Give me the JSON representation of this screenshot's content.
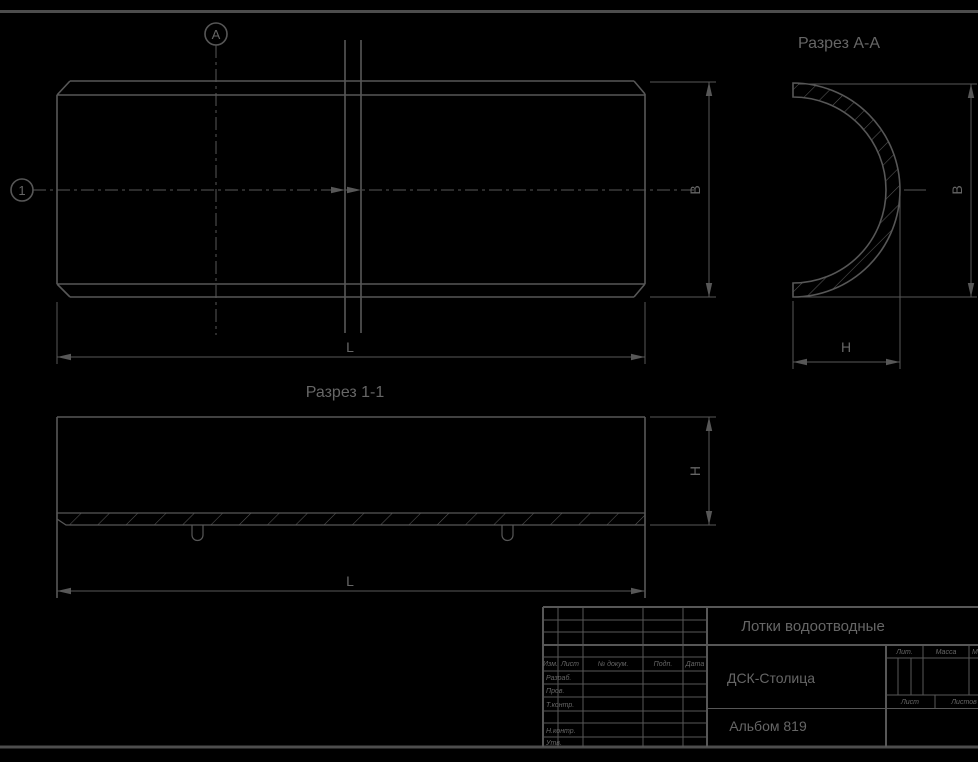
{
  "colors": {
    "background": "#000000",
    "line": "#575757",
    "text": "#666666"
  },
  "plan_view": {
    "marker_a": "А",
    "marker_1": "1",
    "dim_width": "B",
    "dim_length": "L"
  },
  "section_aa": {
    "title": "Разрез А-А",
    "dim_width": "B",
    "dim_depth": "H"
  },
  "section_1_1": {
    "title": "Разрез 1-1",
    "dim_length": "L",
    "dim_height": "H"
  },
  "title_block": {
    "doc_name": "Лотки водоотводные",
    "organization": "ДСК-Столица",
    "album": "Альбом 819",
    "columns": {
      "izm": "Изм.",
      "list": "Лист",
      "doc_num": "№ докум.",
      "podp": "Подп.",
      "data": "Дата"
    },
    "roles": {
      "razrab": "Разраб.",
      "prov": "Пров.",
      "t_kontr": "Т.контр.",
      "n_kontr": "Н.контр.",
      "utv": "Утв."
    },
    "right_panel": {
      "lit": "Лит.",
      "massa": "Масса",
      "masshtab": "Масштаб",
      "list": "Лист",
      "listov": "Листов"
    }
  }
}
